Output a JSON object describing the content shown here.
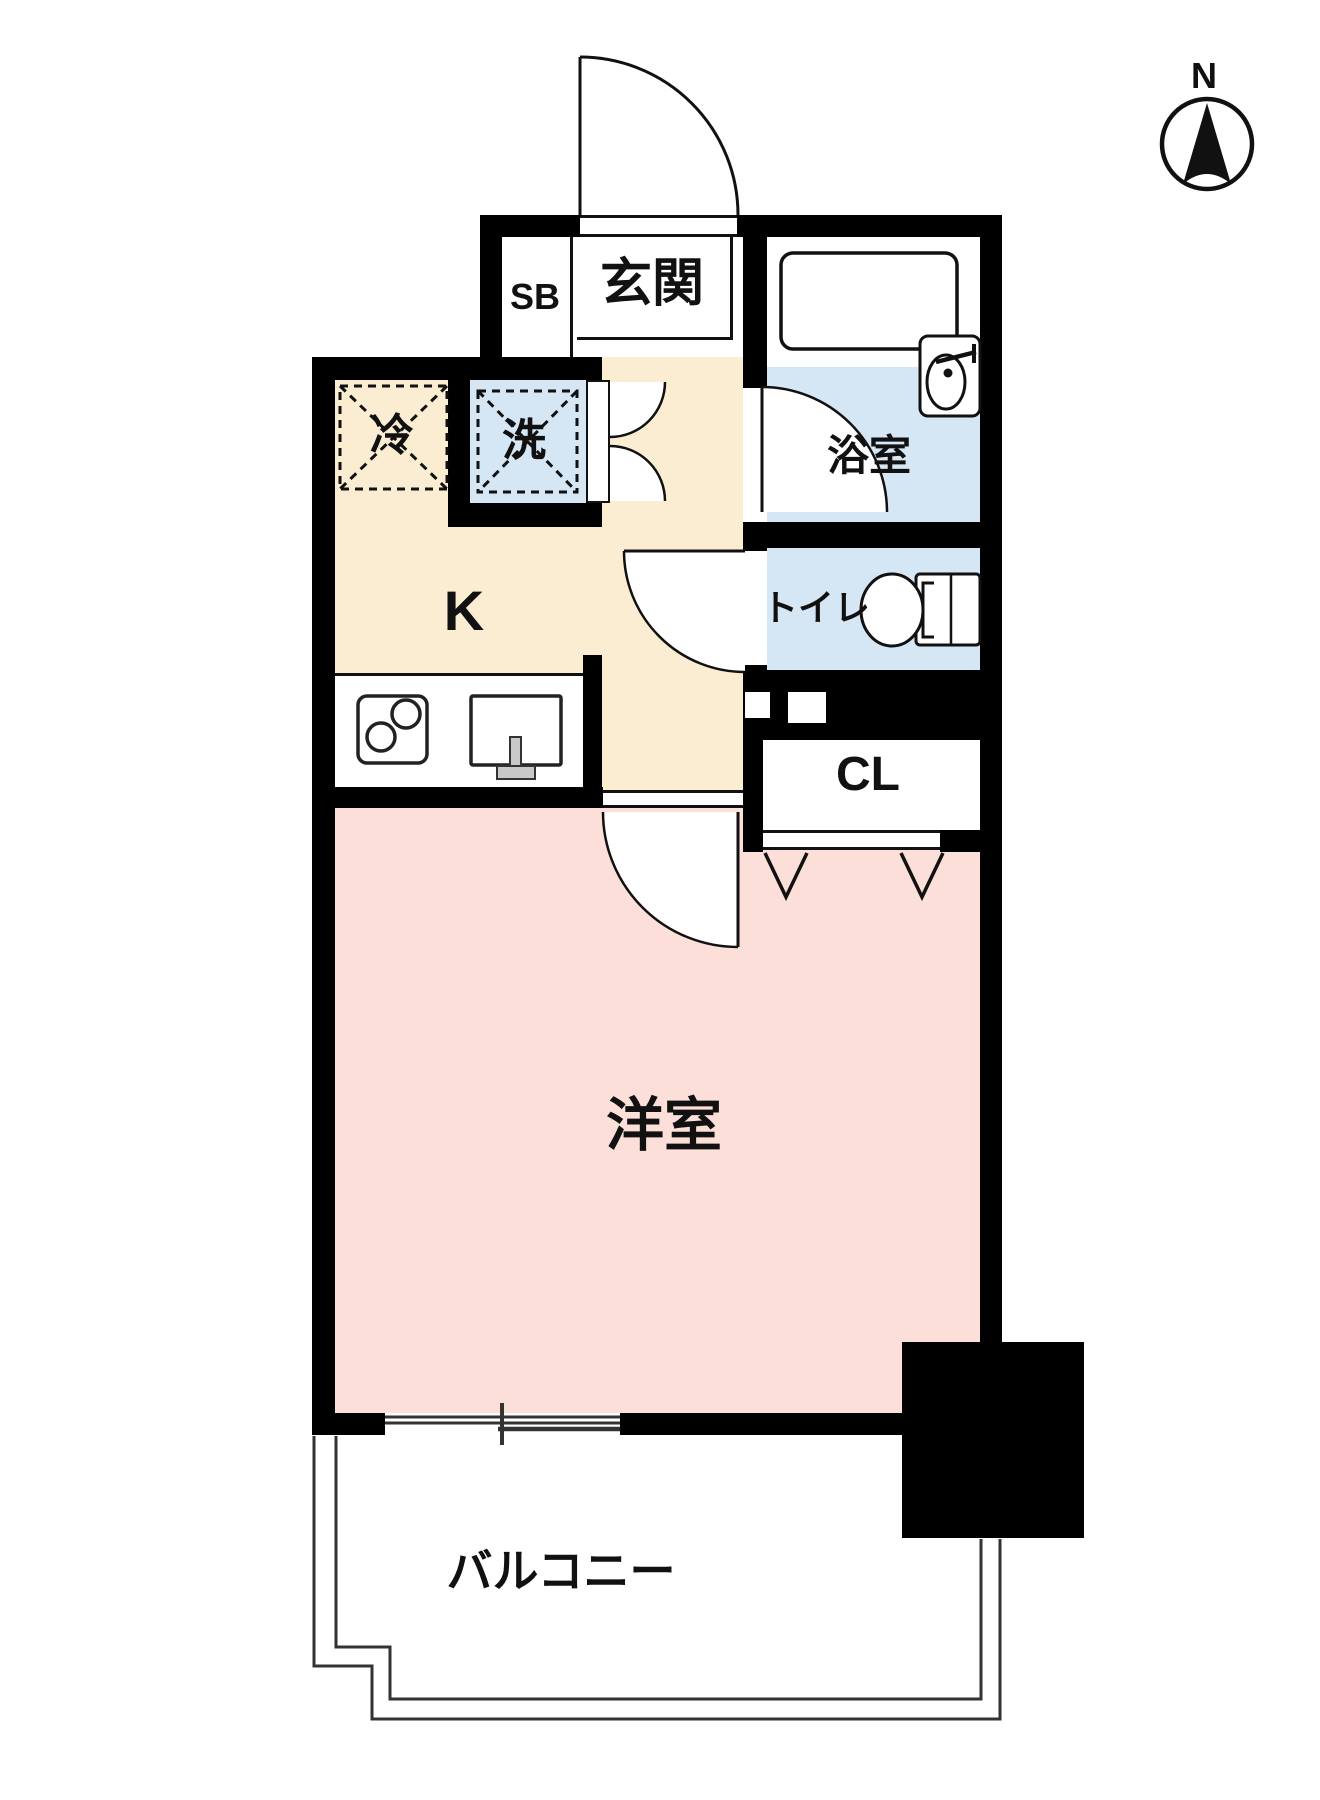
{
  "compass": {
    "label": "N"
  },
  "rooms": {
    "entrance": {
      "label": "玄関"
    },
    "shoe_box": {
      "label": "SB"
    },
    "bathroom": {
      "label": "浴室"
    },
    "toilet": {
      "label": "トイレ"
    },
    "kitchen": {
      "label": "K"
    },
    "closet": {
      "label": "CL"
    },
    "western_room": {
      "label": "洋室"
    },
    "balcony": {
      "label": "バルコニー"
    },
    "refrigerator": {
      "label": "冷"
    },
    "washer": {
      "label": "洗"
    }
  },
  "colors": {
    "wall": "#000000",
    "line": "#111111",
    "floor-cream": "#FBEDD1",
    "floor-blue": "#D5E6F4",
    "floor-pink": "#FBDFD8",
    "thin": "#333333",
    "fixture-gray": "#C9C9C9"
  }
}
